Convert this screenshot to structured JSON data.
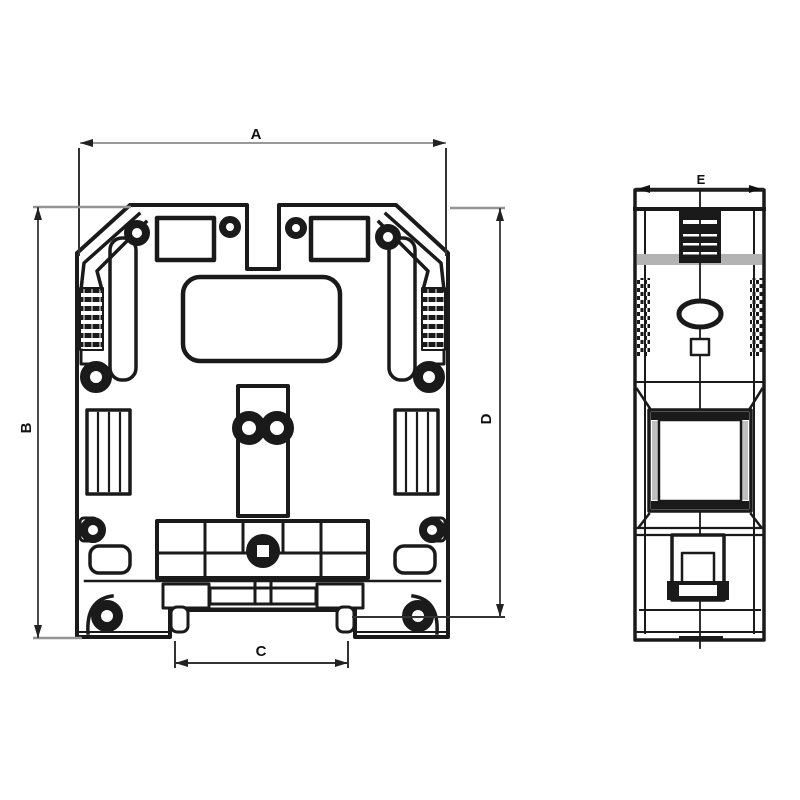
{
  "colors": {
    "background": "#ffffff",
    "outline": "#1a1a1a",
    "dimension_line": "#4a4a4a",
    "extension_line": "#949494",
    "shading_band": "#b3b3b3",
    "label_text": "#111111"
  },
  "views": [
    {
      "name": "front-view"
    },
    {
      "name": "side-view"
    }
  ],
  "dimensions": [
    {
      "label": "A"
    },
    {
      "label": "B"
    },
    {
      "label": "C"
    },
    {
      "label": "D"
    },
    {
      "label": "E"
    }
  ]
}
